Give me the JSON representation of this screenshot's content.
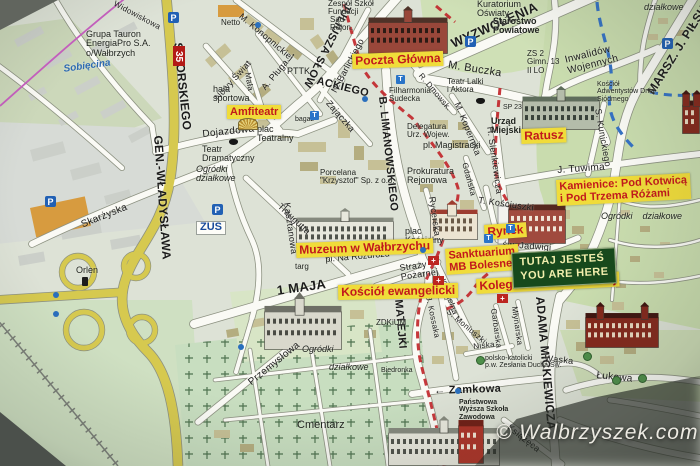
{
  "watermark": "© Walbrzyszek.com",
  "road_number": "35",
  "here_marker": {
    "line1": "TUTAJ JESTEŚ",
    "line2": "YOU ARE HERE"
  },
  "colors": {
    "poi_bg": "#f0dc3a",
    "poi_text": "#c2191c",
    "here_bg": "#17491c",
    "here_text": "#f2efad",
    "main_road_yellow": "#d6c94f",
    "route_red": "#c1272b",
    "water_blue": "#3572c4",
    "boundary_pink": "#c75fc0"
  },
  "poi_labels": [
    {
      "text": "Amfiteatr",
      "x": 227,
      "y": 105,
      "size": 11,
      "rot": 0
    },
    {
      "text": "Poczta Główna",
      "x": 352,
      "y": 54,
      "size": 12,
      "rot": -2
    },
    {
      "text": "Ratusz",
      "x": 521,
      "y": 129,
      "size": 12,
      "rot": -2
    },
    {
      "lines": [
        "Kamienice: Pod Kotwicą",
        "i Pod Trzema Różami"
      ],
      "x": 556,
      "y": 180,
      "size": 11,
      "rot": -3
    },
    {
      "text": "Rynek",
      "x": 484,
      "y": 225,
      "size": 12,
      "rot": -4
    },
    {
      "text": "Muzeum w Wałbrzychu",
      "x": 296,
      "y": 243,
      "size": 12,
      "rot": -2
    },
    {
      "lines": [
        "Sanktuarium",
        "MB Bolesnej"
      ],
      "x": 445,
      "y": 249,
      "size": 11,
      "rot": -4
    },
    {
      "text": "Kolegiata NMP Bolesnej",
      "x": 476,
      "y": 279,
      "size": 12,
      "rot": -3
    },
    {
      "text": "Kościół ewangelicki",
      "x": 338,
      "y": 285,
      "size": 12,
      "rot": -1
    }
  ],
  "street_labels": [
    {
      "text": "SIKORSKIEGO",
      "x": 184,
      "y": 42,
      "rot": 84,
      "size": 12,
      "b": 1
    },
    {
      "text": "GEN.-WŁADYSŁAWA",
      "x": 164,
      "y": 135,
      "rot": 86,
      "size": 12,
      "b": 1
    },
    {
      "text": "JULIUSZA SŁOW",
      "x": 353,
      "y": 6,
      "rot": 117,
      "size": 11,
      "b": 1
    },
    {
      "text": "ACKIEGO",
      "x": 318,
      "y": 76,
      "rot": 14,
      "size": 11,
      "b": 1
    },
    {
      "text": "WYZWOLENIA",
      "x": 449,
      "y": 38,
      "rot": -24,
      "size": 13,
      "b": 1
    },
    {
      "text": "MARSZ. J. PIŁSUDSKIEGO",
      "x": 645,
      "y": 90,
      "rot": -58,
      "size": 12,
      "b": 1
    },
    {
      "text": "B. LIMANOWSKIEGO",
      "x": 387,
      "y": 96,
      "rot": 84,
      "size": 11,
      "b": 1
    },
    {
      "text": "1 MAJA",
      "x": 276,
      "y": 284,
      "rot": -8,
      "size": 13,
      "b": 1
    },
    {
      "text": "J. MATEJKI",
      "x": 402,
      "y": 286,
      "rot": 85,
      "size": 11,
      "b": 1
    },
    {
      "text": "ADAMA MICKIEWICZA",
      "x": 546,
      "y": 296,
      "rot": 85,
      "size": 12,
      "b": 1
    },
    {
      "text": "M. Buczka",
      "x": 449,
      "y": 60,
      "rot": 9,
      "size": 11
    },
    {
      "text": "N. Barlickiego",
      "x": 330,
      "y": 90,
      "rot": -62,
      "size": 9
    },
    {
      "text": "M. Konopnickiej",
      "x": 243,
      "y": 12,
      "rot": 40,
      "size": 9
    },
    {
      "text": "Nowy Świat",
      "x": 213,
      "y": 96,
      "rot": -48,
      "size": 9
    },
    {
      "text": "A. Pługa →",
      "x": 260,
      "y": 86,
      "rot": -50,
      "size": 9
    },
    {
      "text": "Mała",
      "x": 251,
      "y": 72,
      "rot": 80,
      "size": 8
    },
    {
      "text": "Dojazdowa",
      "x": 202,
      "y": 130,
      "rot": -6,
      "size": 10
    },
    {
      "text": "Traugutta",
      "x": 282,
      "y": 202,
      "rot": 43,
      "size": 9
    },
    {
      "text": "Skarżyska",
      "x": 80,
      "y": 221,
      "rot": -22,
      "size": 10
    },
    {
      "text": "Zajączka",
      "x": 331,
      "y": 99,
      "rot": 49,
      "size": 9
    },
    {
      "text": "R. Dmowsk.",
      "x": 423,
      "y": 72,
      "rot": 50,
      "size": 8
    },
    {
      "text": "M. Kopernika",
      "x": 461,
      "y": 101,
      "rot": 68,
      "size": 9
    },
    {
      "text": "H. Sienkiewicza",
      "x": 494,
      "y": 126,
      "rot": 82,
      "size": 9
    },
    {
      "text": "S. Kunickiego",
      "x": 602,
      "y": 108,
      "rot": 80,
      "size": 9
    },
    {
      "text": "J. Tuwima",
      "x": 557,
      "y": 166,
      "rot": -4,
      "size": 10
    },
    {
      "text": "T. Kościuszki",
      "x": 479,
      "y": 196,
      "rot": 8,
      "size": 9
    },
    {
      "text": "Rycerska",
      "x": 436,
      "y": 196,
      "rot": 82,
      "size": 9
    },
    {
      "text": "Gdańska",
      "x": 468,
      "y": 162,
      "rot": 75,
      "size": 8
    },
    {
      "text": "św. Jadwigi",
      "x": 503,
      "y": 240,
      "rot": 4,
      "size": 9
    },
    {
      "text": "Kościelna",
      "x": 446,
      "y": 278,
      "rot": 70,
      "size": 8
    },
    {
      "lines": [
        "Straży",
        "Pożarnej"
      ],
      "x": 399,
      "y": 264,
      "rot": -8,
      "size": 9
    },
    {
      "text": "→ 1 Maja",
      "x": 463,
      "y": 251,
      "rot": -3,
      "size": 9
    },
    {
      "text": "Kasztanowa",
      "x": 291,
      "y": 202,
      "rot": 82,
      "size": 9
    },
    {
      "lines": [
        "Inwalidów",
        "Wojennych"
      ],
      "x": 564,
      "y": 56,
      "rot": -14,
      "size": 10
    },
    {
      "text": "Wąska",
      "x": 545,
      "y": 354,
      "rot": 6,
      "size": 9
    },
    {
      "text": "Łukowa",
      "x": 597,
      "y": 371,
      "rot": 6,
      "size": 10
    },
    {
      "text": "← Zamkowa",
      "x": 434,
      "y": 386,
      "rot": -2,
      "size": 11,
      "b": 1
    },
    {
      "text": "Książęca",
      "x": 511,
      "y": 423,
      "rot": 38,
      "size": 9
    },
    {
      "text": "S. Moniuszki",
      "x": 450,
      "y": 308,
      "rot": 40,
      "size": 8
    },
    {
      "text": "Garbarska",
      "x": 497,
      "y": 308,
      "rot": 82,
      "size": 8
    },
    {
      "text": "Młynarska",
      "x": 518,
      "y": 306,
      "rot": 82,
      "size": 8
    },
    {
      "text": "Niska",
      "x": 473,
      "y": 343,
      "rot": -6,
      "size": 8
    },
    {
      "text": "Przemysłowa",
      "x": 247,
      "y": 380,
      "rot": -39,
      "size": 10
    },
    {
      "text": "J. Kossaka",
      "x": 432,
      "y": 296,
      "rot": 78,
      "size": 8
    },
    {
      "text": "Widowiskowa",
      "x": 116,
      "y": 0,
      "rot": 28,
      "size": 8
    }
  ],
  "place_labels": [
    {
      "lines": [
        "Grupa Tauron",
        "EnergiaPro S.A.",
        "o/Wałbrzych"
      ],
      "x": 86,
      "y": 30,
      "size": 9
    },
    {
      "text": "Sobięcina",
      "x": 63,
      "y": 65,
      "size": 10,
      "cls": "water",
      "rot": -8
    },
    {
      "text": "Netto",
      "x": 221,
      "y": 19,
      "size": 8
    },
    {
      "lines": [
        "hala",
        "sportowa"
      ],
      "x": 213,
      "y": 85,
      "size": 9
    },
    {
      "text": "PTTK",
      "x": 287,
      "y": 67,
      "size": 9
    },
    {
      "lines": [
        "Sąd",
        "Rejon."
      ],
      "x": 330,
      "y": 16,
      "size": 8
    },
    {
      "lines": [
        "Zespół Szkół",
        "Fundacji"
      ],
      "x": 328,
      "y": 0,
      "size": 8
    },
    {
      "lines": [
        "Kuratorium",
        "Oświaty"
      ],
      "x": 477,
      "y": 0,
      "size": 9
    },
    {
      "lines": [
        "Starostwo",
        "Powiatowe"
      ],
      "x": 493,
      "y": 17,
      "size": 9,
      "b": 1
    },
    {
      "lines": [
        "ZS 2",
        "Gimn. 13",
        "II LO"
      ],
      "x": 527,
      "y": 50,
      "size": 8
    },
    {
      "text": "działkowe",
      "x": 644,
      "y": 3,
      "size": 9,
      "i": 1
    },
    {
      "lines": [
        "Kościół",
        "Adwentystów Dnia",
        "Siódmego"
      ],
      "x": 597,
      "y": 81,
      "size": 7
    },
    {
      "lines": [
        "Teatr",
        "Dramatyczny"
      ],
      "x": 202,
      "y": 145,
      "size": 9
    },
    {
      "lines": [
        "plac",
        "Teatralny"
      ],
      "x": 257,
      "y": 125,
      "size": 9
    },
    {
      "lines": [
        "Ogródki",
        "działkowe"
      ],
      "x": 196,
      "y": 165,
      "size": 9,
      "i": 1
    },
    {
      "text": "ZUS",
      "x": 196,
      "y": 221,
      "size": 11,
      "cls": "zus"
    },
    {
      "lines": [
        "Porcelana",
        "\"Krzysztof\" Sp. z o.o."
      ],
      "x": 320,
      "y": 169,
      "size": 8
    },
    {
      "lines": [
        "Filharmonia",
        "Sudecka"
      ],
      "x": 389,
      "y": 87,
      "size": 8
    },
    {
      "lines": [
        "Teatr Lalki",
        "i Aktora"
      ],
      "x": 447,
      "y": 78,
      "size": 8
    },
    {
      "lines": [
        "Delegatura",
        "Urz. Wojew."
      ],
      "x": 407,
      "y": 123,
      "size": 8
    },
    {
      "text": "pl. Magistracki",
      "x": 423,
      "y": 141,
      "size": 9
    },
    {
      "lines": [
        "Prokuratura",
        "Rejonowa"
      ],
      "x": 407,
      "y": 167,
      "size": 9
    },
    {
      "lines": [
        "Urząd",
        "Miejski"
      ],
      "x": 491,
      "y": 117,
      "size": 9,
      "b": 1
    },
    {
      "lines": [
        "plac",
        "Kościelny"
      ],
      "x": 405,
      "y": 227,
      "size": 9
    },
    {
      "text": "pl. Na Rozdrożu",
      "x": 325,
      "y": 255,
      "rot": -5,
      "size": 9
    },
    {
      "text": "targ",
      "x": 295,
      "y": 263,
      "size": 8
    },
    {
      "text": "ZDKiUM",
      "x": 376,
      "y": 319,
      "size": 8
    },
    {
      "text": "Biedronka",
      "x": 381,
      "y": 367,
      "size": 7
    },
    {
      "text": "Cmentarz",
      "x": 297,
      "y": 420,
      "size": 11
    },
    {
      "text": "Ogródki",
      "x": 302,
      "y": 345,
      "size": 9,
      "i": 1
    },
    {
      "text": "działkowe",
      "x": 329,
      "y": 363,
      "size": 9,
      "i": 1
    },
    {
      "text": "Ogródki    działkowe",
      "x": 601,
      "y": 212,
      "size": 9,
      "i": 1
    },
    {
      "text": "Orlen",
      "x": 76,
      "y": 266,
      "size": 9
    },
    {
      "lines": [
        "polsko-katolicki",
        "p.w. Zesłania Ducha Św."
      ],
      "x": 485,
      "y": 355,
      "size": 7
    },
    {
      "lines": [
        "Państwowa",
        "Wyższa Szkoła",
        "Zawodowa"
      ],
      "x": 459,
      "y": 399,
      "size": 7,
      "b": 1
    },
    {
      "text": "SP 23",
      "x": 503,
      "y": 104,
      "size": 7
    },
    {
      "text": "bagaż",
      "x": 295,
      "y": 116,
      "size": 7
    }
  ],
  "icons": [
    {
      "type": "parking",
      "x": 168,
      "y": 12
    },
    {
      "type": "parking",
      "x": 45,
      "y": 196
    },
    {
      "type": "parking",
      "x": 465,
      "y": 36
    },
    {
      "type": "parking",
      "x": 212,
      "y": 204
    },
    {
      "type": "parking",
      "x": 662,
      "y": 38
    },
    {
      "type": "taxi",
      "x": 396,
      "y": 75
    },
    {
      "type": "taxi",
      "x": 506,
      "y": 224
    },
    {
      "type": "taxi",
      "x": 484,
      "y": 234
    },
    {
      "type": "taxi",
      "x": 310,
      "y": 111
    },
    {
      "type": "theater-masks",
      "x": 229,
      "y": 139
    },
    {
      "type": "theater-masks",
      "x": 476,
      "y": 98
    },
    {
      "type": "stop-dot",
      "x": 53,
      "y": 292
    },
    {
      "type": "stop-dot",
      "x": 53,
      "y": 311
    },
    {
      "type": "stop-dot",
      "x": 255,
      "y": 22
    },
    {
      "type": "stop-dot",
      "x": 362,
      "y": 96
    },
    {
      "type": "stop-dot",
      "x": 420,
      "y": 247
    },
    {
      "type": "stop-dot",
      "x": 455,
      "y": 388
    },
    {
      "type": "stop-dot",
      "x": 238,
      "y": 344
    },
    {
      "type": "gas-station",
      "x": 82,
      "y": 277
    },
    {
      "type": "church-cross",
      "x": 428,
      "y": 256
    },
    {
      "type": "church-cross",
      "x": 433,
      "y": 276
    },
    {
      "type": "church-cross",
      "x": 497,
      "y": 294
    },
    {
      "type": "tree",
      "x": 583,
      "y": 352
    },
    {
      "type": "tree",
      "x": 612,
      "y": 376
    },
    {
      "type": "tree",
      "x": 638,
      "y": 374
    },
    {
      "type": "tree",
      "x": 476,
      "y": 356
    },
    {
      "type": "amphitheater",
      "x": 238,
      "y": 118
    }
  ],
  "landmarks": [
    {
      "id": "poczta-glowna",
      "kind": "brick",
      "x": 368,
      "y": 6,
      "w": 80,
      "h": 48
    },
    {
      "id": "ratusz",
      "kind": "palaceGreen",
      "x": 522,
      "y": 86,
      "w": 78,
      "h": 44
    },
    {
      "id": "muzeum",
      "kind": "palaceWhite",
      "x": 296,
      "y": 208,
      "w": 98,
      "h": 40
    },
    {
      "id": "sanktuarium",
      "kind": "churchWhite",
      "x": 430,
      "y": 200,
      "w": 48,
      "h": 40
    },
    {
      "id": "kamienice-rynek",
      "kind": "tenement",
      "x": 508,
      "y": 192,
      "w": 58,
      "h": 52
    },
    {
      "id": "kosciol-ewangelicki",
      "kind": "churchClassic",
      "x": 264,
      "y": 292,
      "w": 78,
      "h": 58
    },
    {
      "id": "kolegiata",
      "kind": "gothic",
      "x": 585,
      "y": 302,
      "w": 74,
      "h": 46
    },
    {
      "id": "pwsz-budynek",
      "kind": "palaceWhite",
      "x": 388,
      "y": 416,
      "w": 112,
      "h": 50
    },
    {
      "id": "kosciol-prawy-brzeg",
      "kind": "gothic",
      "x": 682,
      "y": 90,
      "w": 18,
      "h": 44
    },
    {
      "id": "wieza-czerwona",
      "kind": "towerRed",
      "x": 458,
      "y": 406,
      "w": 26,
      "h": 58
    }
  ]
}
